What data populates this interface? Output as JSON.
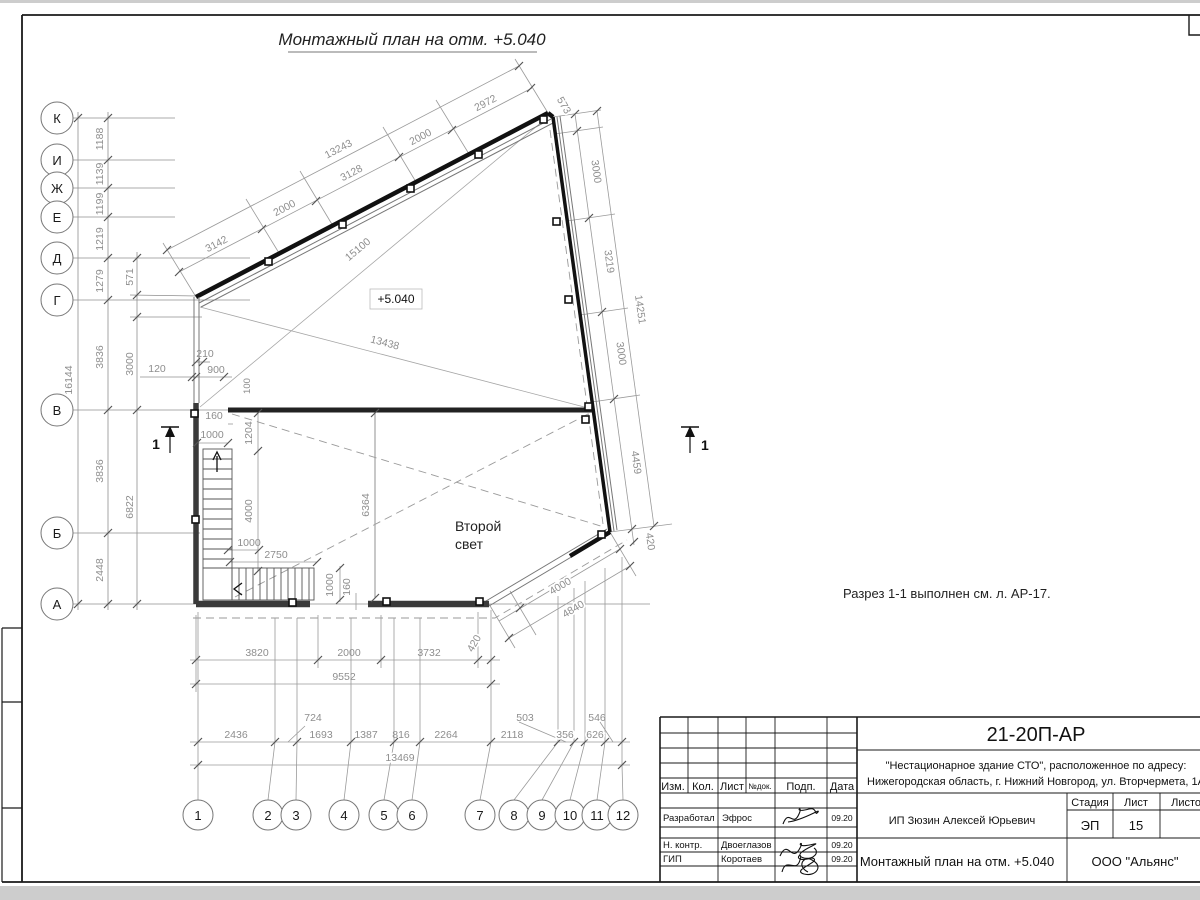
{
  "sheet": {
    "title": "Монтажный план на отм. +5.040",
    "note": "Разрез 1-1 выполнен см. л. АР-17.",
    "level_mark": "+5.040",
    "room_label_line1": "Второй",
    "room_label_line2": "свет",
    "section_mark": "1"
  },
  "axes": {
    "left": [
      "К",
      "И",
      "Ж",
      "Е",
      "Д",
      "Г",
      "В",
      "Б",
      "А"
    ],
    "bottom": [
      "1",
      "2",
      "3",
      "4",
      "5",
      "6",
      "7",
      "8",
      "9",
      "10",
      "11",
      "12"
    ]
  },
  "dims": {
    "left_total": "16144",
    "left_chain": [
      "1188",
      "1139",
      "1199",
      "1219",
      "1279",
      "3836",
      "3836",
      "2448"
    ],
    "aux_571": "571",
    "aux_3000": "3000",
    "aux_6822": "6822",
    "aux_120": "120",
    "aux_210": "210",
    "aux_900": "900",
    "aux_100": "100",
    "top_chain": [
      "3142",
      "2000",
      "3128",
      "2000",
      "2972"
    ],
    "top_total": "13243",
    "right_573": "573",
    "right_chain": [
      "3000",
      "3219",
      "3000",
      "4459"
    ],
    "right_420": "420",
    "right_total": "14251",
    "diag_15100": "15100",
    "diag_13438": "13438",
    "stair_160a": "160",
    "stair_1000a": "1000",
    "stair_1204": "1204",
    "stair_4000": "4000",
    "stair_1000b": "1000",
    "stair_2750": "2750",
    "stair_1000c": "1000",
    "stair_160b": "160",
    "room_6364": "6364",
    "bottom_chain": [
      "3820",
      "2000",
      "3732"
    ],
    "bottom_420": "420",
    "bottom_total": "9552",
    "cut_4000": "4000",
    "cut_4840": "4840",
    "grid_chain": [
      "2436",
      "724",
      "1693",
      "1387",
      "816",
      "2264",
      "2118",
      "503",
      "356",
      "626",
      "546"
    ],
    "grid_total": "13469"
  },
  "titleblock": {
    "doc_number": "21-20П-АР",
    "project_line1": "\"Нестационарное здание СТО\", расположенное по адресу:",
    "project_line2": "Нижегородская область, г. Нижний Новгород, ул. Вторчермета, 1А",
    "header_cols": [
      "Изм.",
      "Кол.",
      "Лист",
      "№док.",
      "Подп.",
      "Дата"
    ],
    "rows": [
      {
        "role": "Разработал",
        "name": "Эфрос",
        "date": "09.20"
      },
      {
        "role": "Н. контр.",
        "name": "Двоеглазов",
        "date": "09.20"
      },
      {
        "role": "ГИП",
        "name": "Коротаев",
        "date": "09.20"
      }
    ],
    "client": "ИП Зюзин Алексей Юрьевич",
    "stage_label": "Стадия",
    "sheet_label": "Лист",
    "sheets_label": "Листов",
    "stage": "ЭП",
    "sheet_no": "15",
    "drawing_name": "Монтажный план на отм. +5.040",
    "company": "ООО \"Альянс\""
  }
}
